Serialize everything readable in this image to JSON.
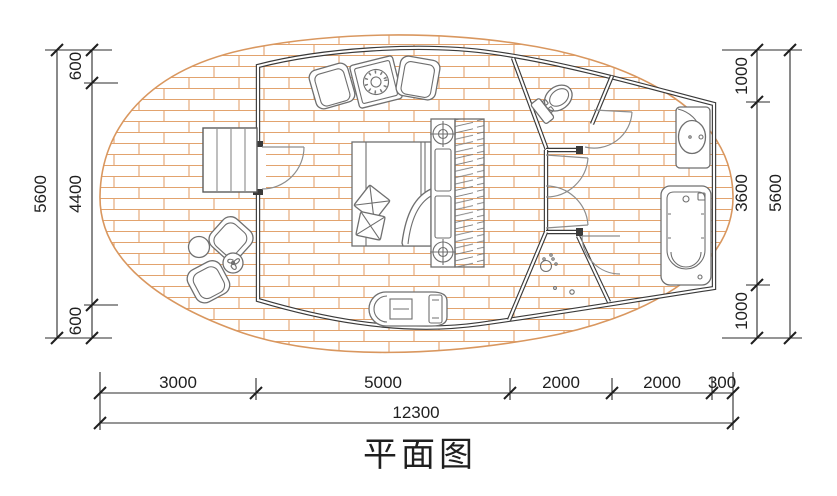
{
  "title": {
    "text": "平面图"
  },
  "dimensions": {
    "left": {
      "total": "5600",
      "segments": [
        "600",
        "4400",
        "600"
      ]
    },
    "right": {
      "total": "5600",
      "segments": [
        "1000",
        "3600",
        "1000"
      ]
    },
    "bottom": {
      "total": "12300",
      "segments": [
        "3000",
        "5000",
        "2000",
        "2000",
        "300"
      ]
    }
  },
  "fixtures": [
    "deck",
    "stairs",
    "entry-door",
    "lounge-chairs",
    "coffee-table",
    "double-bed",
    "headboard-lights",
    "wardrobe",
    "chaise-bench",
    "outdoor-chairs",
    "outdoor-tables",
    "toilet",
    "shower",
    "sink-vanity",
    "bathtub"
  ],
  "colors": {
    "line": "#2b2b2b",
    "wall": "#3a3a3a",
    "deck_brick": "#e2a36e",
    "furniture": "#6f6f6f",
    "background": "#ffffff"
  }
}
